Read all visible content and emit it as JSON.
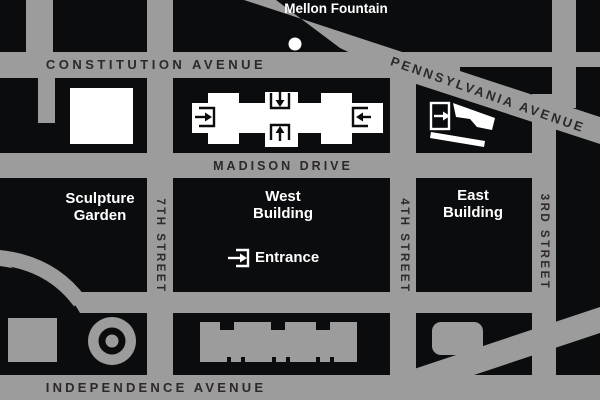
{
  "map": {
    "title": "National Gallery area map",
    "streets": {
      "constitution": "CONSTITUTION AVENUE",
      "pennsylvania": "PENNSYLVANIA AVENUE",
      "madison": "MADISON DRIVE",
      "independence": "INDEPENDENCE AVENUE",
      "seventh": "7TH STREET",
      "fourth": "4TH STREET",
      "third": "3RD STREET"
    },
    "landmarks": {
      "mellon_fountain": "Mellon Fountain",
      "sculpture_garden": "Sculpture Garden",
      "west_building": "West Building",
      "east_building": "East Building",
      "entrance": "Entrance"
    },
    "icons": {
      "entrance_arrow": "arrow-into-bracket entrance symbol",
      "fountain_dot": "white dot marker"
    },
    "colors": {
      "road_gray": "#9b9c9b",
      "block_black": "#0b0c0e",
      "road_label": "#2d282b",
      "building_white": "#ffffff"
    }
  }
}
